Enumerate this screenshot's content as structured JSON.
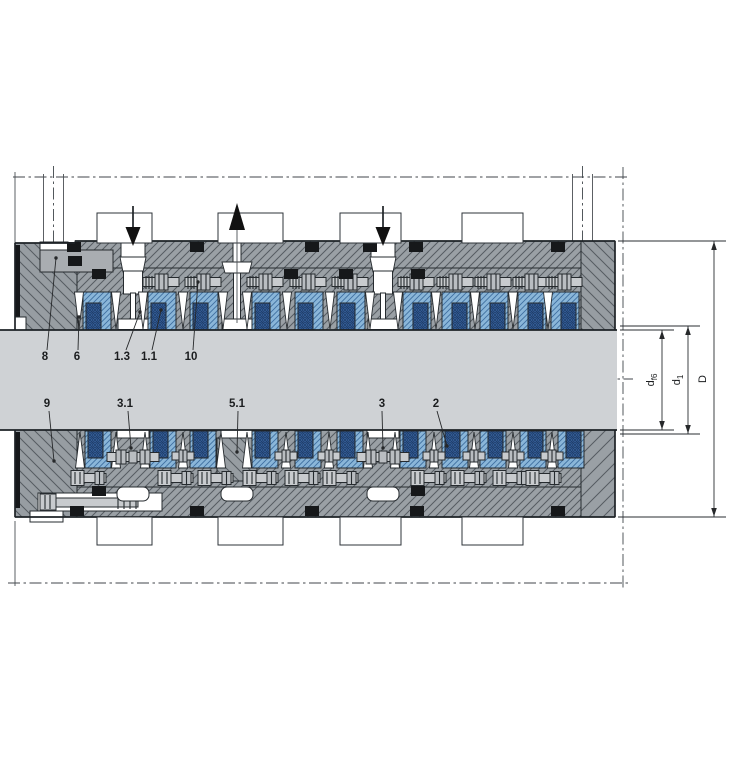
{
  "drawing": {
    "kind": "engineering-cross-section",
    "colors": {
      "background": "#ffffff",
      "housing_gray": "#9aa0a5",
      "housing_gray2": "#979da2",
      "hatch_line": "#565c62",
      "plate_gray": "#a9adb1",
      "shaft_gray": "#cfd2d5",
      "packing_light_blue": "#8ab6d9",
      "packing_blue_line": "#3f6fa0",
      "packing_dark_blue": "#3a66a6",
      "packing_dark_line": "#203f6b",
      "metal": "#c8cbce",
      "metal2": "#b9bdc1",
      "detail_black": "#16181a",
      "line_dark": "#262b2f"
    },
    "part_labels": {
      "top": [
        {
          "text": "8",
          "tx": 45,
          "ty": 360,
          "leader": [
            47,
            350,
            56,
            258
          ]
        },
        {
          "text": "6",
          "tx": 77,
          "ty": 360,
          "leader": [
            78,
            350,
            79,
            317
          ]
        },
        {
          "text": "1.3",
          "tx": 122,
          "ty": 360,
          "leader": [
            126,
            350,
            140,
            312
          ]
        },
        {
          "text": "1.1",
          "tx": 149,
          "ty": 360,
          "leader": [
            152,
            350,
            161,
            310
          ]
        },
        {
          "text": "10",
          "tx": 191,
          "ty": 360,
          "leader": [
            193,
            350,
            198,
            282
          ]
        }
      ],
      "bottom": [
        {
          "text": "9",
          "tx": 47,
          "ty": 407,
          "leader": [
            49,
            411,
            54,
            461
          ]
        },
        {
          "text": "3.1",
          "tx": 125,
          "ty": 407,
          "leader": [
            128,
            411,
            131,
            448
          ]
        },
        {
          "text": "5.1",
          "tx": 237,
          "ty": 407,
          "leader": [
            238,
            411,
            237,
            452
          ]
        },
        {
          "text": "3",
          "tx": 382,
          "ty": 407,
          "leader": [
            382,
            411,
            383,
            448
          ]
        },
        {
          "text": "2",
          "tx": 436,
          "ty": 407,
          "leader": [
            437,
            411,
            447,
            446
          ]
        }
      ]
    },
    "dimensions": [
      {
        "label": "d",
        "sub": "f6",
        "x": 662,
        "from": 330,
        "to": 430,
        "text_x": 654,
        "ext": [
          [
            620,
            330,
            674,
            330
          ],
          [
            620,
            430,
            674,
            430
          ]
        ]
      },
      {
        "label": "d",
        "sub": "1",
        "x": 688,
        "from": 326,
        "to": 434,
        "text_x": 680,
        "ext": [
          [
            620,
            326,
            700,
            326
          ],
          [
            620,
            434,
            700,
            434
          ]
        ]
      },
      {
        "label": "D",
        "sub": "",
        "x": 714,
        "from": 241,
        "to": 517,
        "text_x": 706,
        "ext": [
          [
            618,
            241,
            726,
            241
          ],
          [
            618,
            517,
            726,
            517
          ]
        ]
      }
    ],
    "flow_arrows": [
      {
        "dir": "down",
        "x": 133
      },
      {
        "dir": "up",
        "x": 237
      },
      {
        "dir": "down",
        "x": 383
      }
    ],
    "ports": {
      "top": [
        {
          "x": 97,
          "w": 55
        },
        {
          "x": 218,
          "w": 65
        },
        {
          "x": 340,
          "w": 61
        },
        {
          "x": 462,
          "w": 61
        }
      ],
      "bottom": [
        {
          "x": 97,
          "w": 55
        },
        {
          "x": 218,
          "w": 65
        },
        {
          "x": 340,
          "w": 61
        },
        {
          "x": 462,
          "w": 61
        }
      ]
    },
    "centerlines": [
      [
        13,
        177,
        627,
        177
      ],
      [
        0,
        379,
        633,
        379
      ],
      [
        8,
        583,
        628,
        583
      ],
      [
        623,
        167,
        623,
        591
      ],
      [
        53.5,
        166,
        53.5,
        259
      ],
      [
        582.5,
        166,
        582.5,
        252
      ]
    ],
    "construction_lines": [
      [
        15,
        172,
        15,
        243
      ],
      [
        15,
        521,
        15,
        586
      ],
      [
        43.5,
        174,
        43.5,
        246
      ],
      [
        63.5,
        174,
        63.5,
        246
      ],
      [
        572.5,
        174,
        572.5,
        241
      ],
      [
        592.5,
        174,
        592.5,
        241
      ]
    ],
    "channels_top": [
      {
        "x": 133,
        "type": "down"
      },
      {
        "x": 237,
        "type": "up"
      },
      {
        "x": 383,
        "type": "down"
      }
    ],
    "channels_bottom": [
      133,
      237,
      383
    ],
    "packing_top": {
      "w": 28,
      "blocks": [
        {
          "x": 83,
          "side": "L"
        },
        {
          "x": 148,
          "side": "L"
        },
        {
          "x": 190,
          "side": "L"
        },
        {
          "x": 252,
          "side": "L"
        },
        {
          "x": 295,
          "side": "L"
        },
        {
          "x": 337,
          "side": "L"
        },
        {
          "x": 403,
          "side": "R"
        },
        {
          "x": 442,
          "side": "R"
        },
        {
          "x": 480,
          "side": "R"
        },
        {
          "x": 518,
          "side": "R"
        },
        {
          "x": 551,
          "side": "R"
        }
      ]
    },
    "packing_bottom": {
      "w": 26,
      "blocks": [
        {
          "x": 85,
          "side": "L"
        },
        {
          "x": 150,
          "side": "L"
        },
        {
          "x": 190,
          "side": "L"
        },
        {
          "x": 252,
          "side": "L"
        },
        {
          "x": 295,
          "side": "L"
        },
        {
          "x": 337,
          "side": "L"
        },
        {
          "x": 400,
          "side": "L"
        },
        {
          "x": 442,
          "side": "L"
        },
        {
          "x": 480,
          "side": "R"
        },
        {
          "x": 520,
          "side": "R"
        },
        {
          "x": 558,
          "side": "R"
        }
      ]
    },
    "wedges_top": [
      79,
      116,
      143,
      183,
      223,
      247,
      287,
      330,
      370,
      398,
      436,
      475,
      513,
      548
    ],
    "wedges_bottom": [
      80,
      116,
      145,
      183,
      221,
      247,
      286,
      329,
      368,
      395,
      434,
      474,
      513,
      552
    ],
    "studs_top": [
      162,
      204,
      266,
      309,
      351,
      417,
      456,
      494,
      532,
      565
    ],
    "screws_bottom": [
      88,
      175,
      215,
      260,
      302,
      340,
      428,
      468,
      510,
      543
    ],
    "gap_studs_bottom": [
      183,
      286,
      329,
      434,
      474,
      513,
      552
    ],
    "couplings_bottom": [
      133,
      383
    ],
    "oring_squares": {
      "top": [
        [
          67,
          242
        ],
        [
          190,
          242
        ],
        [
          305,
          242
        ],
        [
          363,
          242
        ],
        [
          409,
          242
        ],
        [
          551,
          242
        ],
        [
          68,
          256
        ],
        [
          92,
          269
        ],
        [
          284,
          269
        ],
        [
          339,
          269
        ],
        [
          411,
          269
        ]
      ],
      "bottom": [
        [
          70,
          506
        ],
        [
          190,
          506
        ],
        [
          305,
          506
        ],
        [
          410,
          506
        ],
        [
          551,
          506
        ],
        [
          92,
          486
        ],
        [
          411,
          486
        ]
      ]
    }
  }
}
